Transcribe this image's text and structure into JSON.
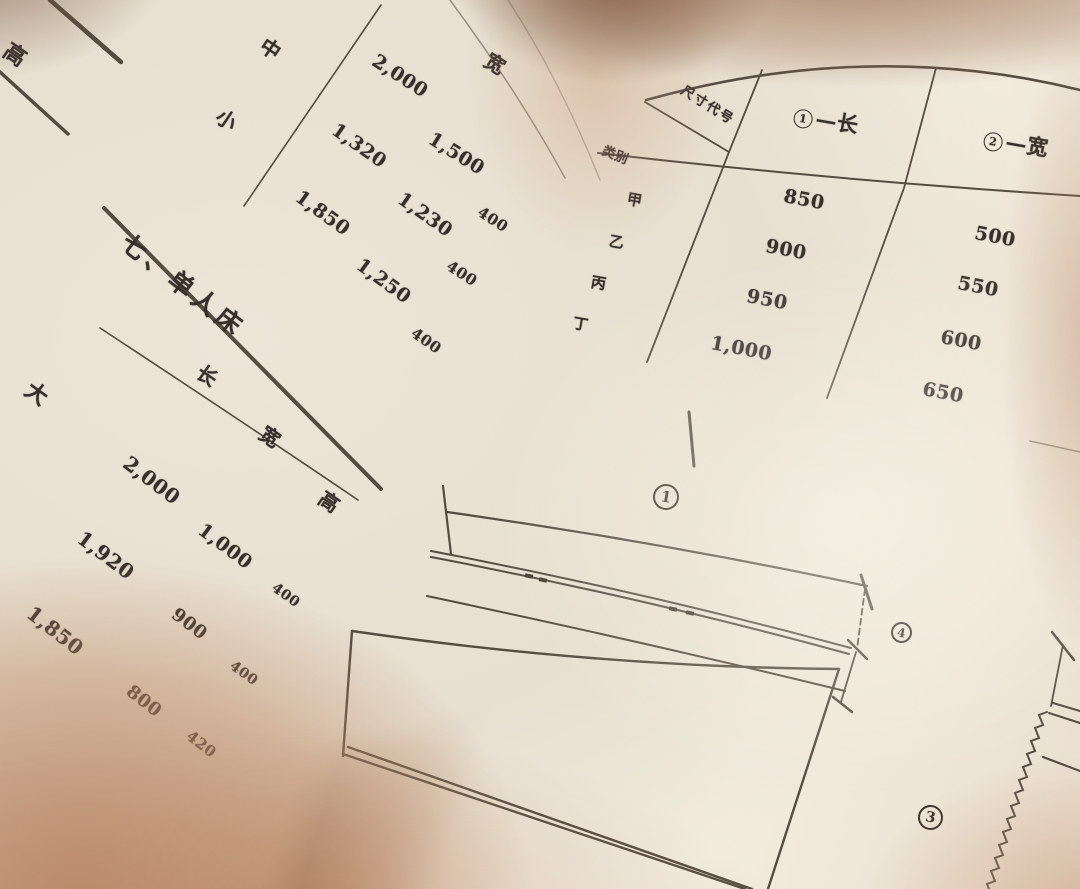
{
  "photo_description": "Open book page photo, furniture dimension tables and bed drawing",
  "left_page": {
    "table_fragment_top": {
      "cells": [
        "高",
        "中",
        "小",
        "宽",
        "2,000",
        "1,500",
        "1,320",
        "1,230",
        "1,850",
        "1,250",
        "400",
        "400",
        "400"
      ]
    },
    "section_heading": "七、单人床",
    "table_single_bed": {
      "row_labels": [
        "大",
        "中"
      ],
      "col_headers": [
        "长",
        "宽",
        "高"
      ],
      "values": [
        "2,000",
        "1,000",
        "400",
        "1,920",
        "900",
        "400",
        "1,850",
        "800",
        "420"
      ]
    }
  },
  "right_page": {
    "spec_table": {
      "corner_top_label": "尺寸代号",
      "corner_bottom_label": "类别",
      "col_headers": [
        {
          "num": "1",
          "dash": "—",
          "label": "长",
          "display": "①—长"
        },
        {
          "num": "2",
          "dash": "—",
          "label": "宽",
          "display": "②—宽"
        }
      ],
      "row_labels": [
        "甲",
        "乙",
        "丙",
        "丁"
      ],
      "col1_values": [
        "850",
        "900",
        "950",
        "1,000"
      ],
      "col2_values": [
        "500",
        "550",
        "600",
        "650"
      ]
    },
    "figure_labels": [
      {
        "num": "1",
        "display": "①"
      },
      {
        "num": "4",
        "display": "④"
      },
      {
        "num": "3",
        "display": "③"
      }
    ]
  }
}
